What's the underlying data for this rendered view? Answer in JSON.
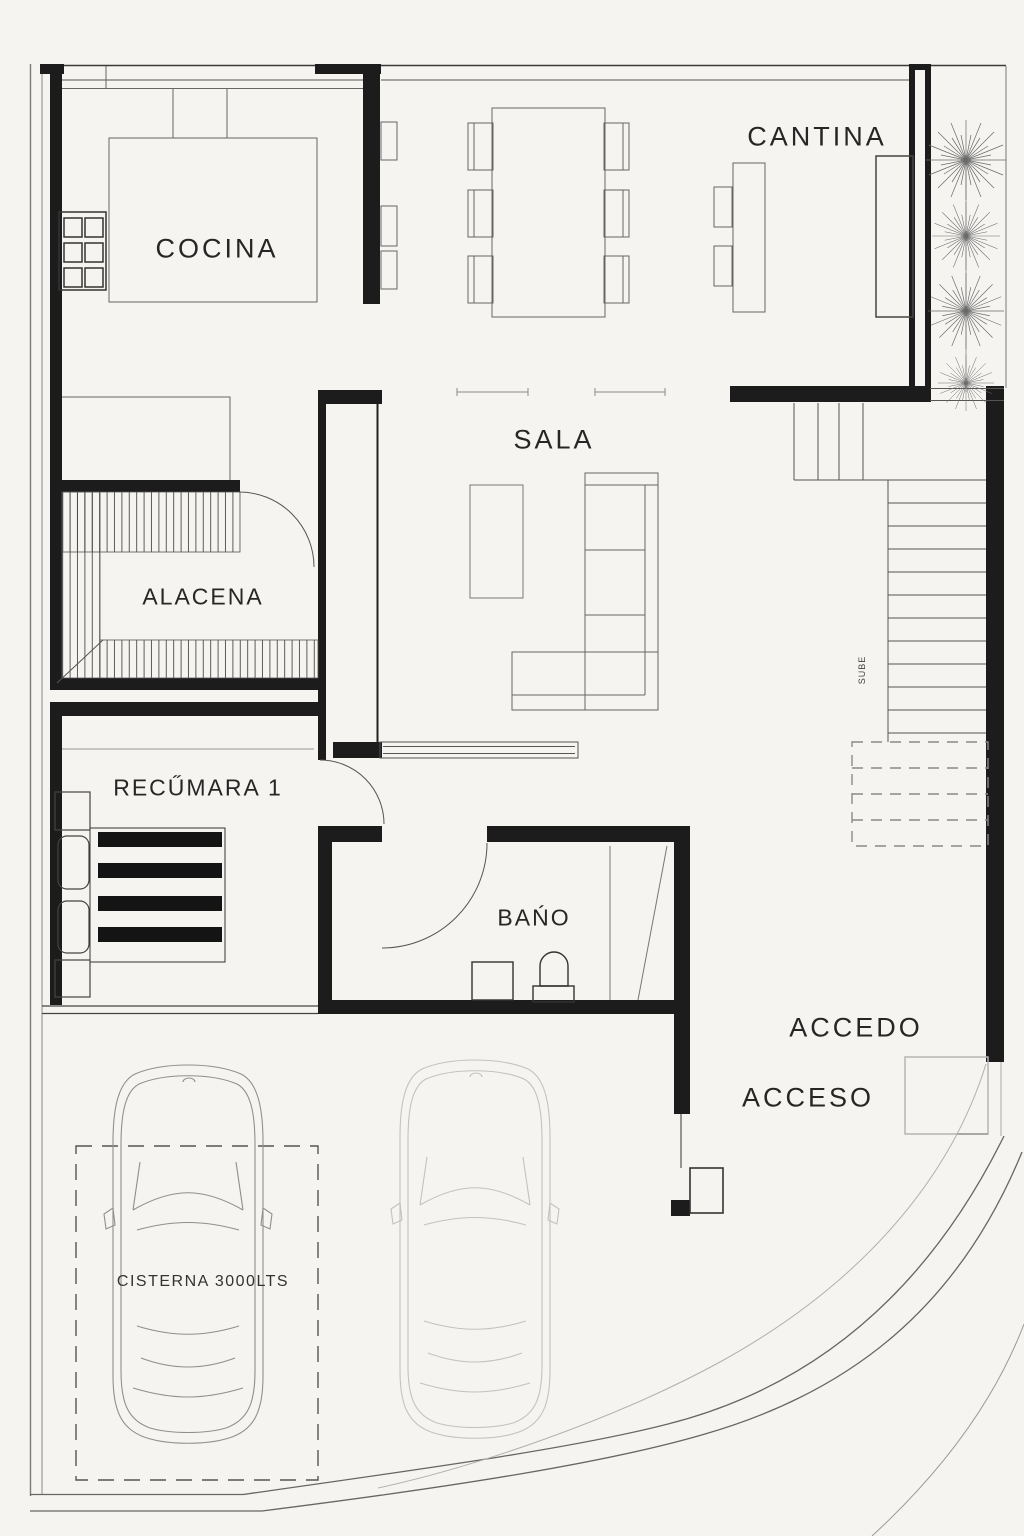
{
  "plan": {
    "title": "single-storey house floor plan",
    "rooms": {
      "cocina": {
        "label": "COCINA"
      },
      "cantina": {
        "label": "CANTINA"
      },
      "sala": {
        "label": "SALA"
      },
      "alacena": {
        "label": "ALACENA"
      },
      "recamara1": {
        "label": "RECŰMARA 1"
      },
      "bano": {
        "label": "BAŃO"
      }
    },
    "annotations": {
      "accedo": "ACCEDO",
      "acceso": "ACCESO",
      "cisterna": "CISTERNA 3000LTS",
      "stairs_direction": "SUBE"
    },
    "colors": {
      "background": "#f5f4f1",
      "wall": "#1c1c1c",
      "line_medium": "#555555",
      "line_light": "#999999",
      "car_dark": "#8f8f8f",
      "car_light": "#c2c2c2",
      "text": "#262626"
    }
  }
}
